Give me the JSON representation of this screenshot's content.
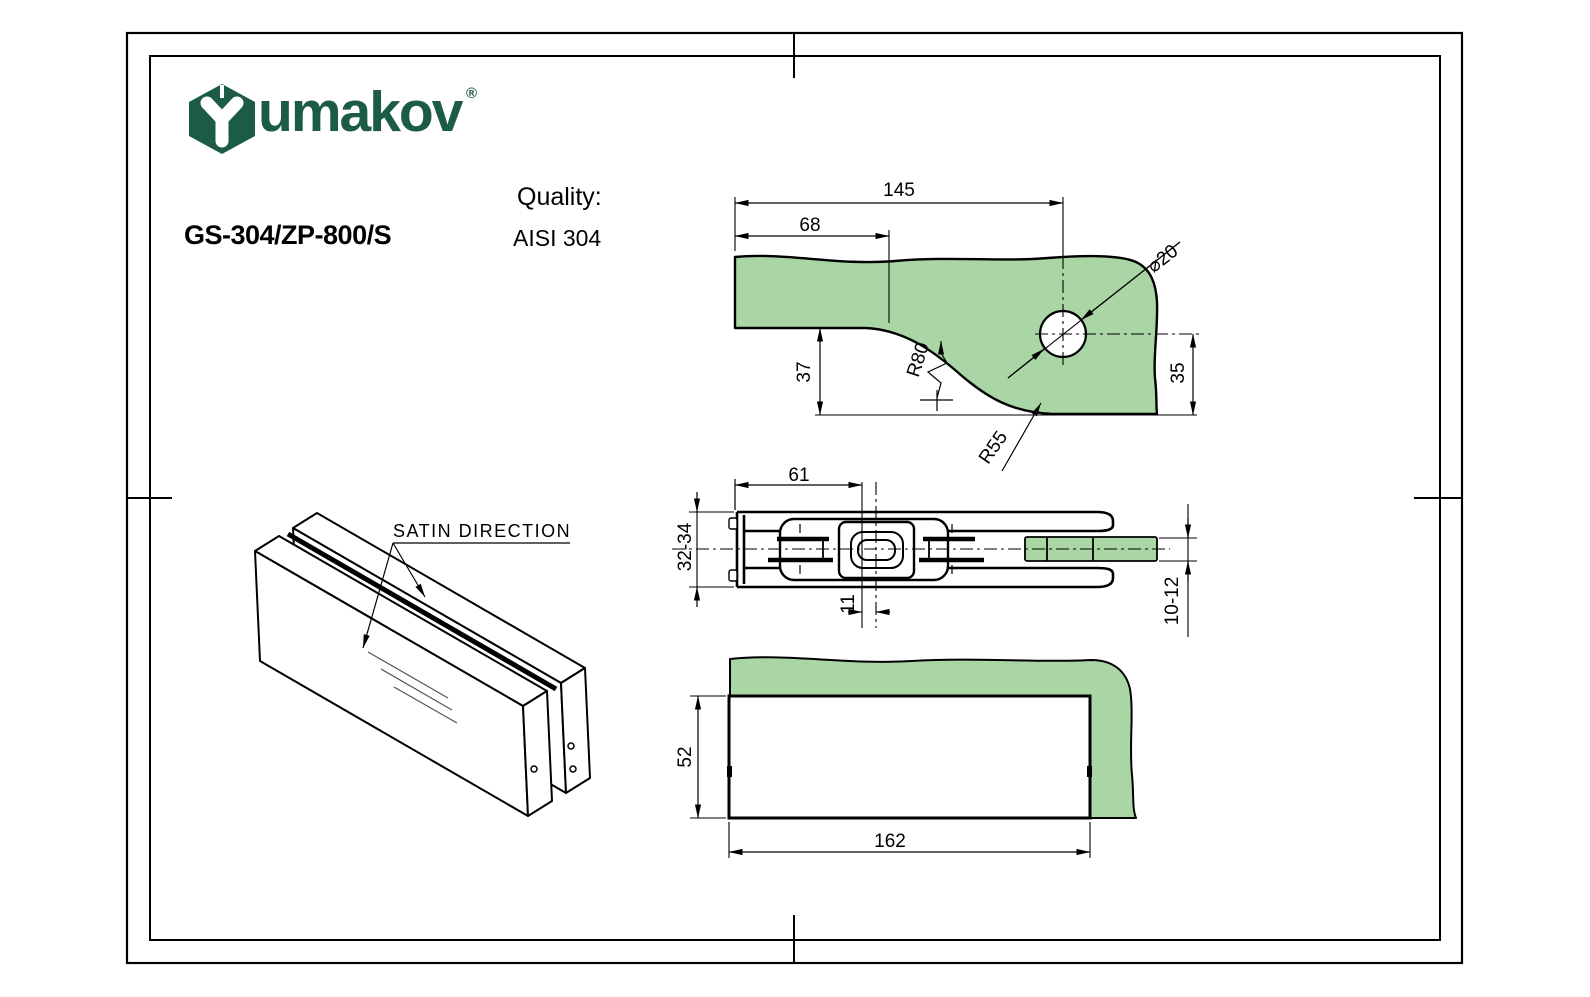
{
  "sheet": {
    "brand": {
      "name": "umakov",
      "registered": "®",
      "logo_color": "#1c5c45"
    },
    "header": {
      "product_code": "GS-304/ZP-800/S",
      "quality_label": "Quality:",
      "quality_value": "AISI 304"
    },
    "colors": {
      "glass_green": "#a9d6a4",
      "line_black": "#000000"
    },
    "iso_view": {
      "note": "SATIN DIRECTION"
    },
    "top_view": {
      "dims": {
        "overall_to_hole": "145",
        "to_curve_start": "68",
        "hole_diameter": "⌀20",
        "corner_offset": "37",
        "hole_to_edge": "35",
        "radius_upper": "R80",
        "radius_lower": "R55"
      }
    },
    "section_view": {
      "dims": {
        "left_to_insert": "61",
        "body_thickness": "32-34",
        "insert_to_pivot": "11",
        "glass_thickness": "10-12"
      }
    },
    "front_view": {
      "dims": {
        "height": "52",
        "length": "162"
      }
    }
  }
}
